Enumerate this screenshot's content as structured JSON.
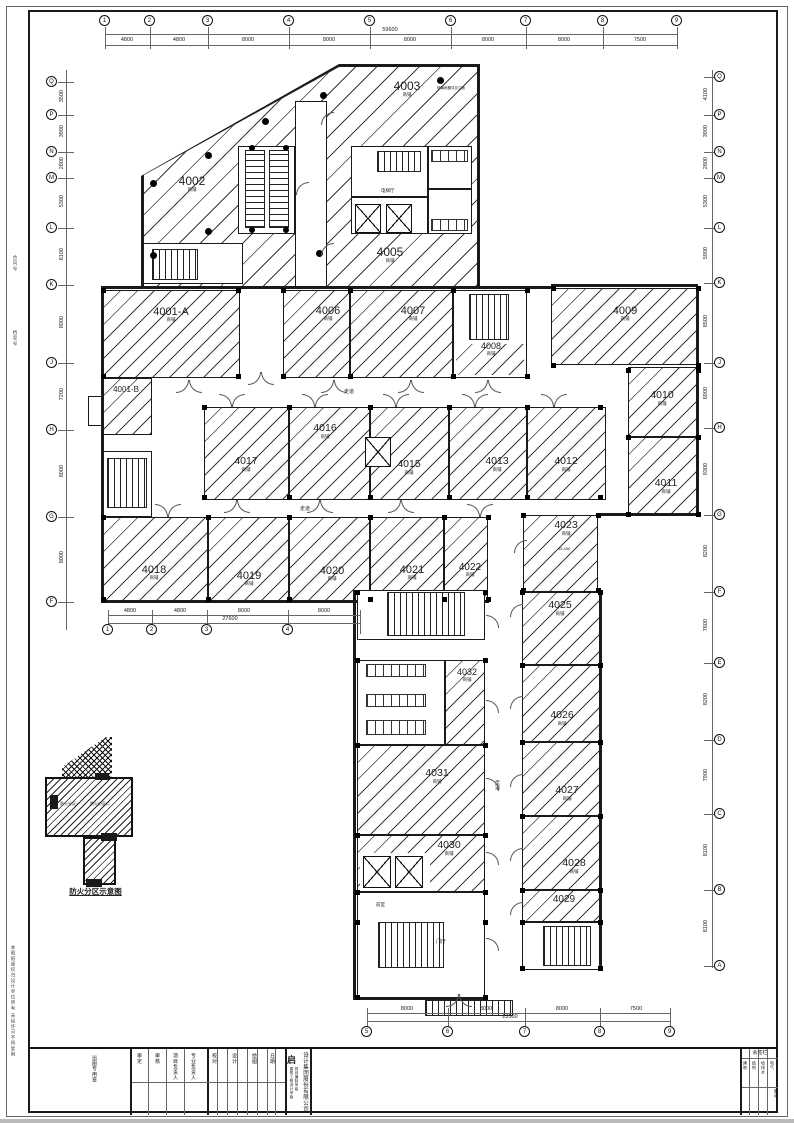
{
  "drawing": {
    "key_plan_caption": "防火分区示意图",
    "key_plan_zone1": "防火分区一",
    "key_plan_zone2": "防火分区二",
    "margin_note1": "合同号",
    "margin_note2": "档案号",
    "margin_note3": "本图纸版权归设计单位所有 未经许可不得复制",
    "corridor_label": "走道",
    "lobby_label": "门厅",
    "elev_lobby_label": "电梯厅",
    "vestibule_label": "前室",
    "note_4003": "玻璃雨棚详见立面",
    "elev_4023": "45.450"
  },
  "rooms": [
    {
      "id": "4001-A",
      "label": "4001-A",
      "sub": "商铺"
    },
    {
      "id": "4001-B",
      "label": "4001-B",
      "sub": ""
    },
    {
      "id": "4002",
      "label": "4002",
      "sub": "商铺"
    },
    {
      "id": "4003",
      "label": "4003",
      "sub": "商铺"
    },
    {
      "id": "4005",
      "label": "4005",
      "sub": "商铺"
    },
    {
      "id": "4006",
      "label": "4006",
      "sub": "商铺"
    },
    {
      "id": "4007",
      "label": "4007",
      "sub": "商铺"
    },
    {
      "id": "4008",
      "label": "4008",
      "sub": "商铺"
    },
    {
      "id": "4009",
      "label": "4009",
      "sub": "商铺"
    },
    {
      "id": "4010",
      "label": "4010",
      "sub": "商铺"
    },
    {
      "id": "4011",
      "label": "4011",
      "sub": "商铺"
    },
    {
      "id": "4012",
      "label": "4012",
      "sub": "商铺"
    },
    {
      "id": "4013",
      "label": "4013",
      "sub": "商铺"
    },
    {
      "id": "4015",
      "label": "4015",
      "sub": "商铺"
    },
    {
      "id": "4016",
      "label": "4016",
      "sub": "商铺"
    },
    {
      "id": "4017",
      "label": "4017",
      "sub": "商铺"
    },
    {
      "id": "4018",
      "label": "4018",
      "sub": "商铺"
    },
    {
      "id": "4019",
      "label": "4019",
      "sub": "商铺"
    },
    {
      "id": "4020",
      "label": "4020",
      "sub": "商铺"
    },
    {
      "id": "4021",
      "label": "4021",
      "sub": "商铺"
    },
    {
      "id": "4022",
      "label": "4022",
      "sub": "商铺"
    },
    {
      "id": "4023",
      "label": "4023",
      "sub": "商铺"
    },
    {
      "id": "4025",
      "label": "4025",
      "sub": "商铺"
    },
    {
      "id": "4026",
      "label": "4026",
      "sub": "商铺"
    },
    {
      "id": "4027",
      "label": "4027",
      "sub": "商铺"
    },
    {
      "id": "4028",
      "label": "4028",
      "sub": "商铺"
    },
    {
      "id": "4029",
      "label": "4029",
      "sub": "商铺"
    },
    {
      "id": "4030",
      "label": "4030",
      "sub": "商铺"
    },
    {
      "id": "4031",
      "label": "4031",
      "sub": "商铺"
    },
    {
      "id": "4032",
      "label": "4032",
      "sub": "商铺"
    }
  ],
  "grid": {
    "cols": [
      "1",
      "2",
      "3",
      "4",
      "5",
      "6",
      "7",
      "8",
      "9"
    ],
    "col_dims": [
      "4800",
      "4800",
      "8000",
      "8000",
      "8000",
      "8000",
      "8000",
      "7500"
    ],
    "col_total": "59600",
    "mid_cols": [
      "1",
      "2",
      "3",
      "4"
    ],
    "mid_dims": [
      "4800",
      "4800",
      "8000",
      "8000"
    ],
    "mid_total": "27600",
    "wing_cols": [
      "5",
      "6",
      "7",
      "8",
      "9"
    ],
    "wing_dims": [
      "8000",
      "8000",
      "8000",
      "7500"
    ],
    "wing_total": "23500",
    "rows_left": [
      "Q",
      "P",
      "N",
      "M",
      "L",
      "K",
      "J",
      "H",
      "G",
      "F"
    ],
    "row_dims_left": [
      "3500",
      "3900",
      "2800",
      "5300",
      "6100",
      "8000",
      "7200",
      "8000",
      "8000"
    ],
    "rows_right": [
      "Q",
      "P",
      "N",
      "M",
      "L",
      "K",
      "J",
      "H",
      "G",
      "F",
      "E",
      "D",
      "C",
      "B",
      "A"
    ],
    "row_dims_right": [
      "4100",
      "3900",
      "2800",
      "5300",
      "5900",
      "8500",
      "6900",
      "9300",
      "8200",
      "7600",
      "8200",
      "7900",
      "8100",
      "8100"
    ]
  },
  "titleblock": {
    "company_logo": "启",
    "company": "设计集团股份有限公司",
    "cert1": "建筑工程设计甲级",
    "cert2": "规划编制甲级",
    "stamp_cell": "出图专用章",
    "fields": [
      "审定",
      "审核",
      "项目负责人",
      "专业负责人",
      "校对",
      "设计",
      "绘图",
      "日期"
    ],
    "sign_title": "会签栏",
    "sign_cols": [
      "建筑",
      "结构",
      "给排水",
      "电气",
      "暖通"
    ]
  }
}
